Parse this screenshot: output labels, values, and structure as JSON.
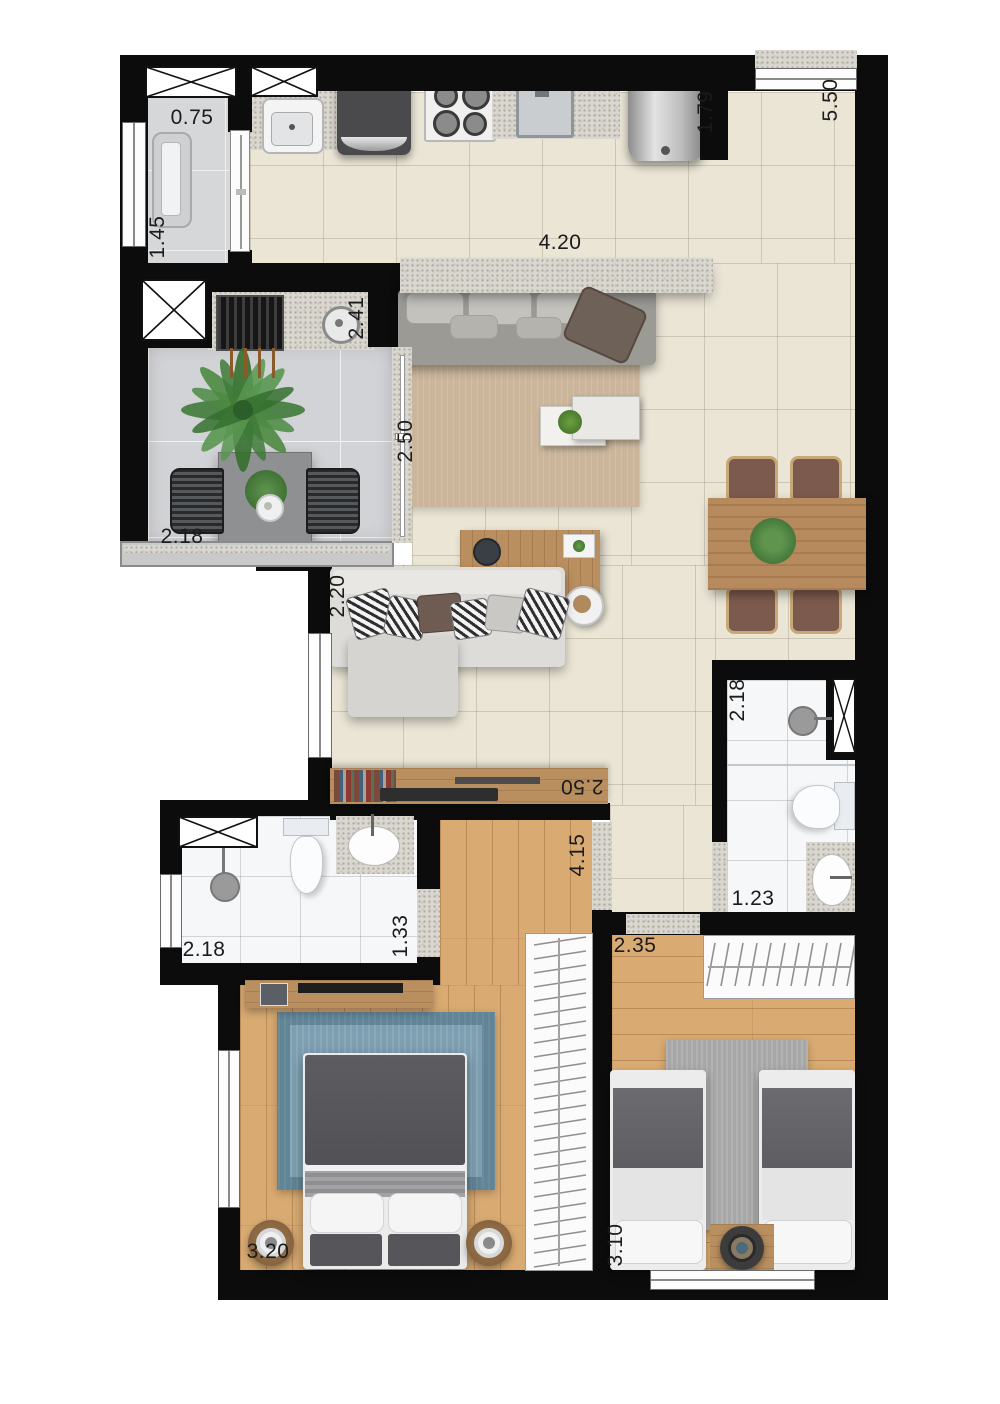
{
  "dimensions": {
    "service_width": "0.75",
    "service_depth": "1.45",
    "grill_counter": "2.41",
    "kitchen_island": "4.20",
    "water_heater": "1.79",
    "living_depth": "5.50",
    "balcony_width": "2.18",
    "balcony_depth": "2.50",
    "living_wall": "2.20",
    "desk_wall": "2.50",
    "master_depth": "4.15",
    "bath_suite_width": "2.18",
    "bath_suite_depth": "1.33",
    "bath_social_depth": "2.18",
    "bath_social_width": "1.23",
    "master_width": "3.20",
    "bedroom2_width": "2.35",
    "bedroom2_depth": "3.10"
  },
  "colors": {
    "wall": "#0c0c0c",
    "tile_floor": "#eae5d5",
    "balcony_floor": "#d2d3d6",
    "wood_floor": "#d9ab72",
    "bath_floor": "#f6f7f9",
    "granite": "#dad7d0",
    "label_text": "#1b1b1b",
    "master_rug": "#7d9fb1",
    "bedroom2_rug": "#a7a7a7",
    "duvet": "#57575b"
  }
}
